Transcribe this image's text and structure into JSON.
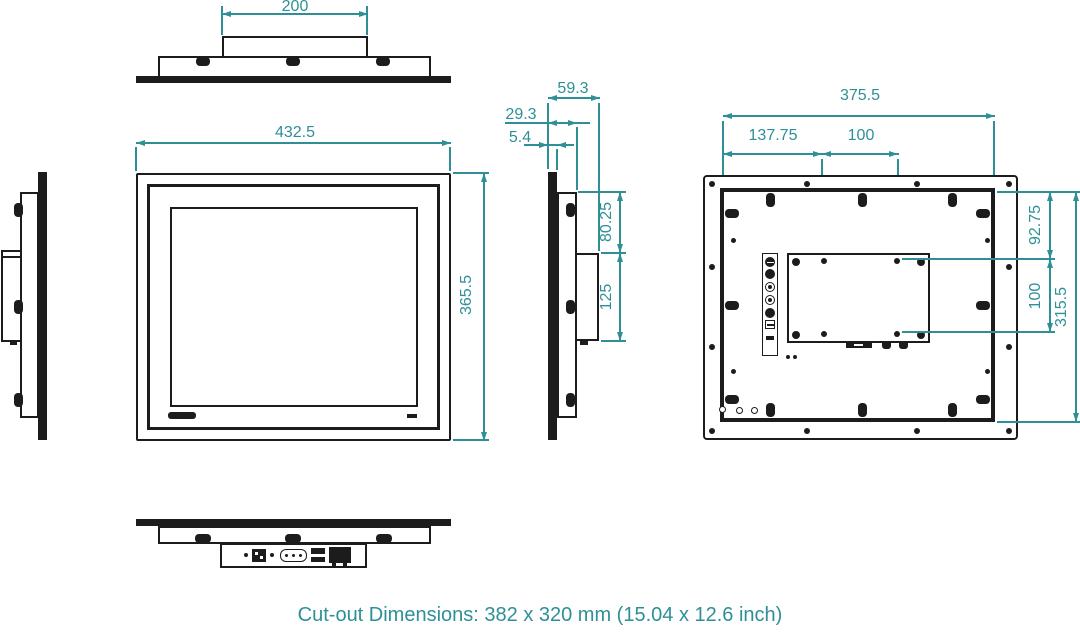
{
  "caption": "Cut-out Dimensions: 382 x 320 mm (15.04 x 12.6 inch)",
  "colors": {
    "dimension_teal": "#2e9096",
    "line_black": "#1c1c1c"
  },
  "dimensions": {
    "top_view": {
      "rear_box_width": "200"
    },
    "front_view": {
      "width": "432.5",
      "height": "365.5"
    },
    "side_view": {
      "total_depth": "59.3",
      "body_depth": "29.3",
      "bezel_thickness": "5.4",
      "top_to_box": "80.25",
      "box_height": "125"
    },
    "rear_view": {
      "chassis_width": "375.5",
      "vesa_left_offset": "137.75",
      "vesa_pitch_h": "100",
      "vesa_top_offset": "92.75",
      "vesa_pitch_v": "100",
      "chassis_height": "315.5"
    }
  }
}
